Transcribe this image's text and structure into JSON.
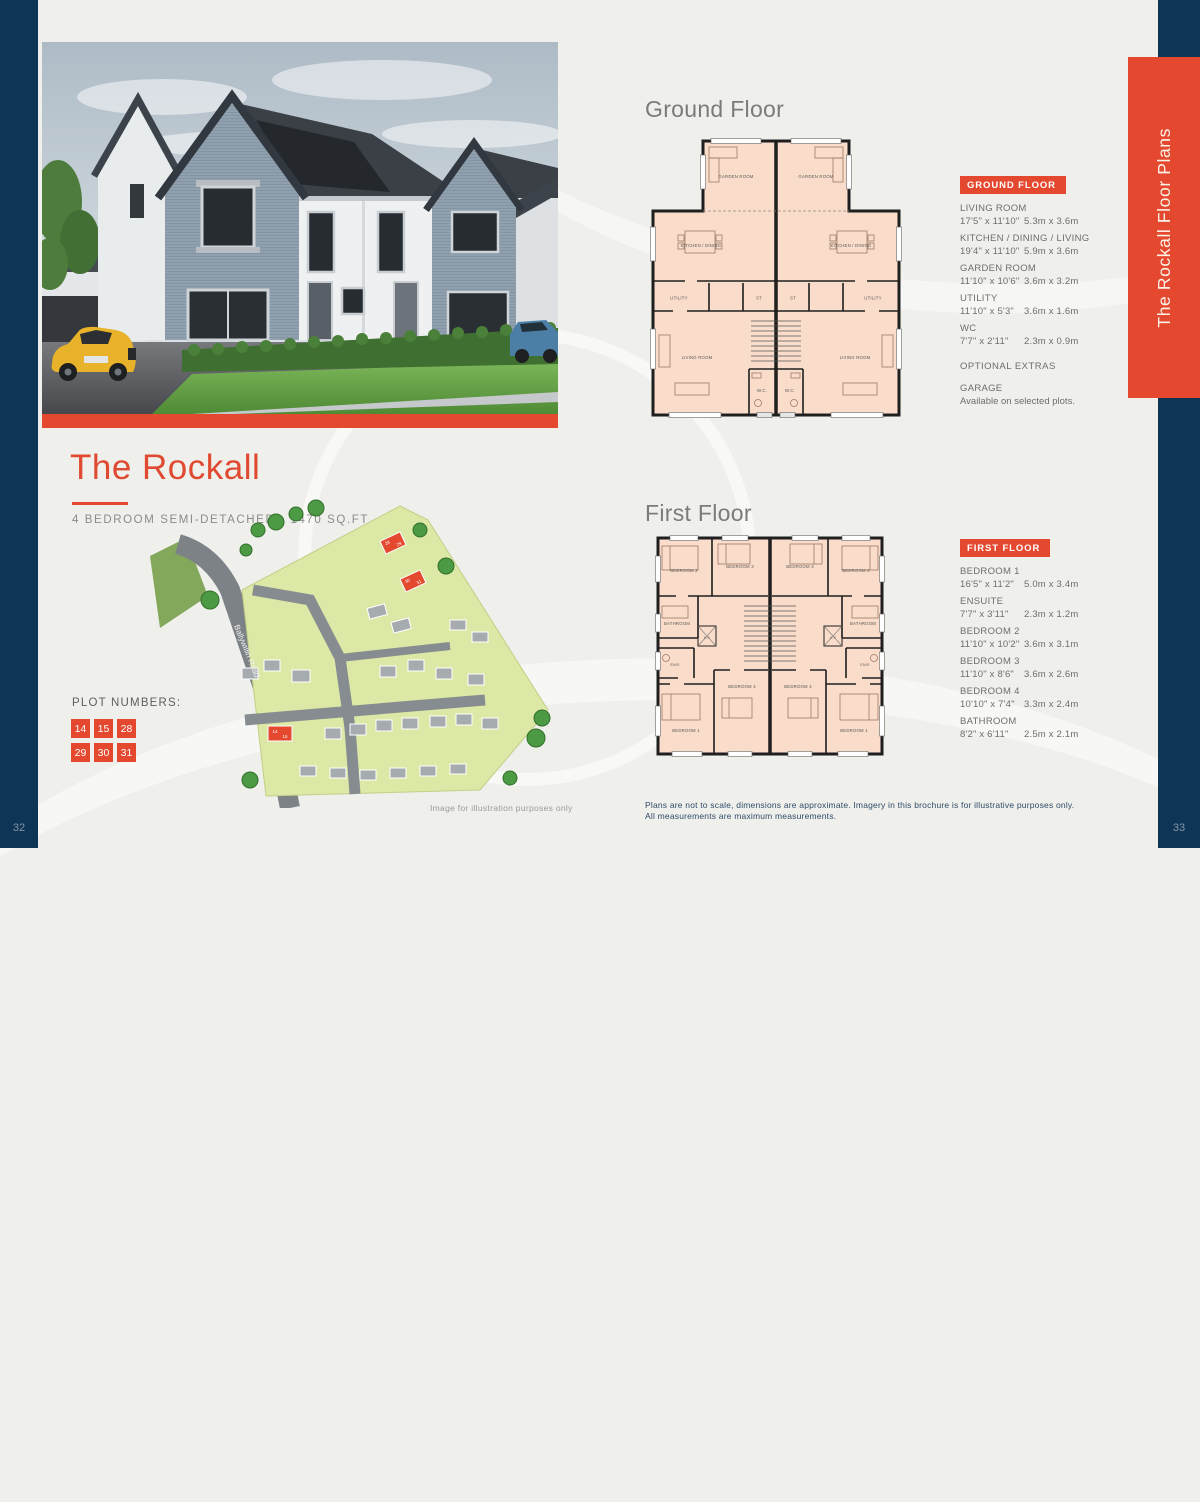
{
  "page": {
    "left_number": "32",
    "right_number": "33",
    "side_banner": "The Rockall Floor Plans",
    "disclaimer_line1": "Plans are not to scale, dimensions are approximate. Imagery in this brochure is for illustrative purposes only.",
    "disclaimer_line2": "All measurements are maximum measurements.",
    "colors": {
      "accent_orange": "#e4482e",
      "navy": "#0e3456",
      "plan_room_fill": "#f9dcc9",
      "background": "#efefec"
    }
  },
  "left": {
    "title": "The Rockall",
    "subtitle": "4 BEDROOM SEMI-DETACHED - 1470 SQ.FT.",
    "plot_numbers_label": "PLOT NUMBERS:",
    "plots": [
      "14",
      "15",
      "28",
      "29",
      "30",
      "31"
    ],
    "site_road_label": "Ballywillin Road",
    "image_caption": "Image for illustration purposes only"
  },
  "ground_floor": {
    "heading": "Ground Floor",
    "panel_title": "GROUND FLOOR",
    "rooms": [
      {
        "name": "LIVING ROOM",
        "imperial": "17'5\" x 11'10\"",
        "metric": "5.3m x 3.6m"
      },
      {
        "name": "KITCHEN / DINING / LIVING",
        "imperial": "19'4\" x 11'10\"",
        "metric": "5.9m x 3.6m"
      },
      {
        "name": "GARDEN ROOM",
        "imperial": "11'10\" x 10'6\"",
        "metric": "3.6m x 3.2m"
      },
      {
        "name": "UTILITY",
        "imperial": "11'10\" x 5'3\"",
        "metric": "3.6m x 1.6m"
      },
      {
        "name": "WC",
        "imperial": "7'7\" x 2'11\"",
        "metric": "2.3m x 0.9m"
      }
    ],
    "optional_extras_label": "OPTIONAL EXTRAS",
    "garage": {
      "name": "GARAGE",
      "note": "Available on selected plots."
    },
    "plan_labels": {
      "garden": "GARDEN ROOM",
      "kitchen": "KITCHEN / DINING",
      "utility": "UTILITY",
      "store": "ST",
      "living": "LIVING ROOM",
      "wc": "W.C."
    }
  },
  "first_floor": {
    "heading": "First Floor",
    "panel_title": "FIRST FLOOR",
    "rooms": [
      {
        "name": "BEDROOM 1",
        "imperial": "16'5\" x 11'2\"",
        "metric": "5.0m x 3.4m"
      },
      {
        "name": "ENSUITE",
        "imperial": "7'7\" x 3'11\"",
        "metric": "2.3m x 1.2m"
      },
      {
        "name": "BEDROOM 2",
        "imperial": "11'10\" x 10'2\"",
        "metric": "3.6m x 3.1m"
      },
      {
        "name": "BEDROOM 3",
        "imperial": "11'10\" x 8'6\"",
        "metric": "3.6m x 2.6m"
      },
      {
        "name": "BEDROOM 4",
        "imperial": "10'10\" x 7'4\"",
        "metric": "3.3m x 2.4m"
      },
      {
        "name": "BATHROOM",
        "imperial": "8'2\" x 6'11\"",
        "metric": "2.5m x 2.1m"
      }
    ],
    "plan_labels": {
      "bed1": "BEDROOM 1",
      "bed2": "BEDROOM 2",
      "bed3": "BEDROOM 3",
      "bed4": "BEDROOM 4",
      "bathroom": "BATHROOM",
      "ensuite": "EN/S",
      "hotpress": "H.P"
    }
  }
}
